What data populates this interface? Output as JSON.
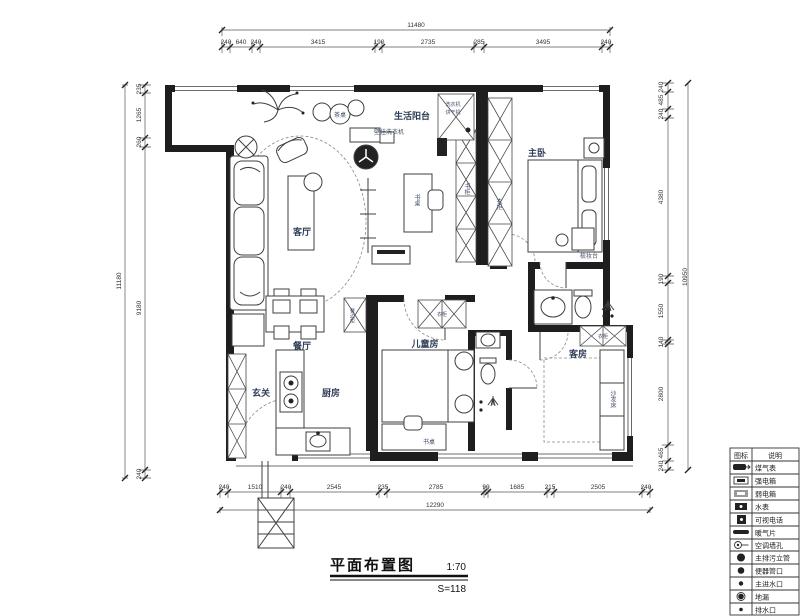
{
  "title": {
    "text": "平面布置图",
    "scale": "1:70",
    "sub": "S=118"
  },
  "rooms": {
    "living_balcony": "生活阳台",
    "master_bedroom": "主卧",
    "living_room": "客厅",
    "dining_room": "餐厅",
    "entry": "玄关",
    "kitchen": "厨房",
    "kids_room": "儿童房",
    "guest_room": "客房"
  },
  "furniture": {
    "wall_washer": "壁挂洗衣机",
    "tea_table": "茶桌",
    "study_desk": "书桌",
    "bookcase": "书柜",
    "master_wardrobe": "衣柜",
    "dresser": "梳妆台",
    "kids_wardrobe": "衣柜",
    "guest_wardrobe": "衣柜",
    "sofa_bed": "沙发床",
    "kids_desk": "书桌",
    "sideboard": "餐边柜",
    "balcony_cabinet_line1": "洗衣机",
    "balcony_cabinet_line2": "烘干机"
  },
  "dimensions": {
    "top": {
      "total": "11480",
      "segments": [
        "240",
        "640",
        "240",
        "3415",
        "190",
        "2735",
        "285",
        "3495",
        "240"
      ]
    },
    "bottom": {
      "total": "12290",
      "segments": [
        "240",
        "1510",
        "240",
        "2545",
        "235",
        "2785",
        "90",
        "1685",
        "215",
        "2505",
        "240"
      ]
    },
    "left": {
      "total": "11180",
      "segments": [
        "235",
        "1265",
        "260",
        "9180",
        "240"
      ]
    },
    "right": {
      "total": "10950",
      "segments": [
        "240",
        "485",
        "240",
        "4380",
        "190",
        "1550",
        "140",
        "2800",
        "465",
        "240"
      ]
    }
  },
  "legend": {
    "header": {
      "icon": "图标",
      "desc": "说明"
    },
    "rows": [
      {
        "icon": "gas-meter-icon",
        "label": "煤气表"
      },
      {
        "icon": "strong-power-box-icon",
        "label": "强电箱"
      },
      {
        "icon": "weak-power-box-icon",
        "label": "弱电箱"
      },
      {
        "icon": "water-meter-icon",
        "label": "水表"
      },
      {
        "icon": "video-intercom-icon",
        "label": "可视电话"
      },
      {
        "icon": "radiator-icon",
        "label": "暖气片"
      },
      {
        "icon": "ac-wall-hole-icon",
        "label": "空调墙孔"
      },
      {
        "icon": "main-sewage-riser-icon",
        "label": "主排污立管"
      },
      {
        "icon": "toilet-pipe-icon",
        "label": "便器管口"
      },
      {
        "icon": "main-water-inlet-icon",
        "label": "主进水口"
      },
      {
        "icon": "floor-drain-icon",
        "label": "地漏"
      },
      {
        "icon": "drain-outlet-icon",
        "label": "排水口"
      }
    ]
  },
  "colors": {
    "wall": "#1e1e1e",
    "label": "#2f3e57",
    "dim_text": "#333333",
    "line": "#3f3f3f"
  }
}
